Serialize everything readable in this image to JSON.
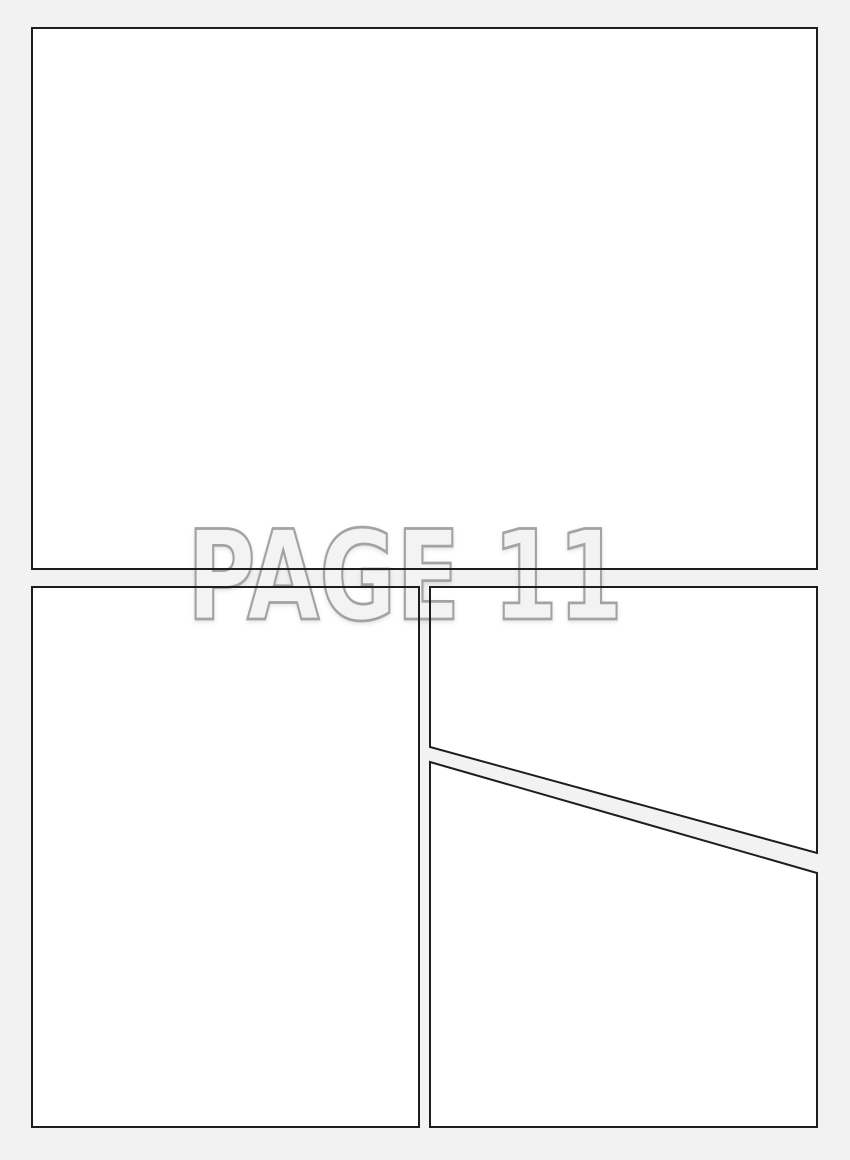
{
  "watermark": {
    "text": "PAGE 11"
  },
  "colors": {
    "page_background": "#f2f2f2",
    "panel_fill": "#ffffff",
    "panel_border": "#1d1d1d",
    "watermark_fill": "#f3f3f3",
    "watermark_outline": "#a3a3a3"
  },
  "panels": [
    {
      "id": "panel-1"
    },
    {
      "id": "panel-2"
    },
    {
      "id": "panel-3"
    },
    {
      "id": "panel-4"
    }
  ]
}
